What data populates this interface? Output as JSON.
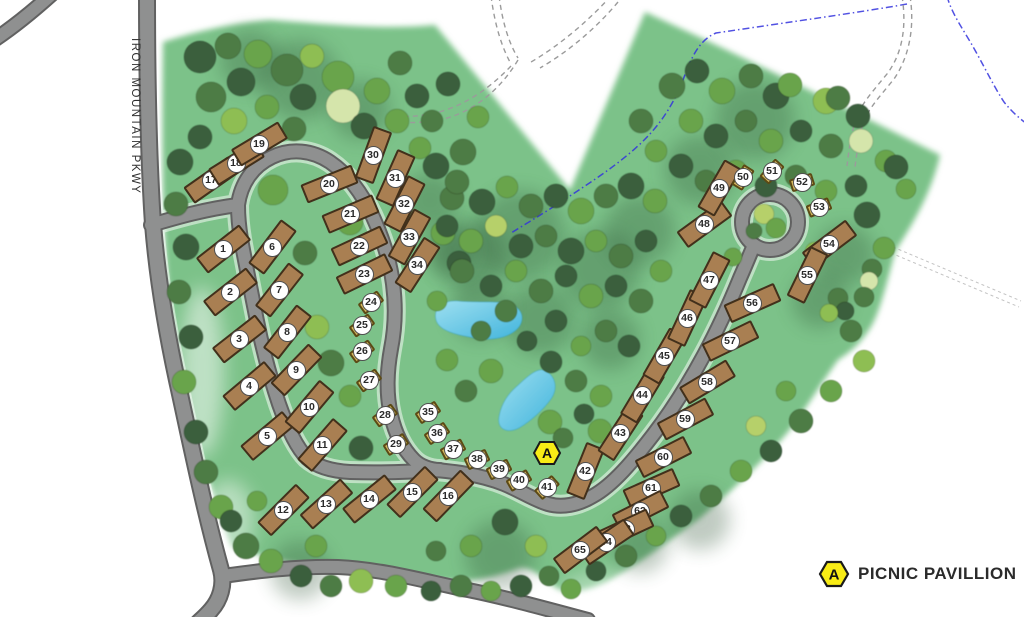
{
  "map": {
    "parkway_label": "IRON MOUNTAIN PKWY",
    "pavilion_marker": {
      "label": "A",
      "x": 547,
      "y": 453
    },
    "legend": {
      "marker_label": "A",
      "label": "PICNIC PAVILLION"
    }
  },
  "site_types": {
    "rv": {
      "w": 55,
      "h": 20
    },
    "tent": {
      "w": 24,
      "h": 13
    }
  },
  "sites_format": [
    "number",
    "x",
    "y",
    "angle_deg",
    "type"
  ],
  "sites": [
    [
      1,
      223,
      249,
      -38,
      "rv"
    ],
    [
      2,
      230,
      292,
      -38,
      "rv"
    ],
    [
      3,
      239,
      339,
      -38,
      "rv"
    ],
    [
      4,
      249,
      386,
      -40,
      "rv"
    ],
    [
      5,
      267,
      436,
      -40,
      "rv"
    ],
    [
      6,
      272,
      247,
      -53,
      "rv"
    ],
    [
      7,
      279,
      290,
      -52,
      "rv"
    ],
    [
      8,
      287,
      332,
      -52,
      "rv"
    ],
    [
      9,
      296,
      370,
      -46,
      "rv"
    ],
    [
      10,
      309,
      407,
      -50,
      "rv"
    ],
    [
      11,
      322,
      445,
      -49,
      "rv"
    ],
    [
      12,
      283,
      510,
      -45,
      "rv"
    ],
    [
      13,
      326,
      504,
      -42,
      "rv"
    ],
    [
      14,
      369,
      499,
      -39,
      "rv"
    ],
    [
      15,
      412,
      492,
      -45,
      "rv"
    ],
    [
      16,
      448,
      496,
      -46,
      "rv"
    ],
    [
      17,
      211,
      180,
      -35,
      "rv"
    ],
    [
      18,
      236,
      163,
      -32,
      "rv"
    ],
    [
      19,
      259,
      144,
      -31,
      "rv"
    ],
    [
      20,
      329,
      184,
      -22,
      "rv"
    ],
    [
      21,
      350,
      214,
      -23,
      "rv"
    ],
    [
      22,
      359,
      246,
      -25,
      "rv"
    ],
    [
      23,
      364,
      274,
      -26,
      "rv"
    ],
    [
      24,
      371,
      302,
      -36,
      "tent"
    ],
    [
      25,
      362,
      325,
      -36,
      "tent"
    ],
    [
      26,
      362,
      351,
      -36,
      "tent"
    ],
    [
      27,
      369,
      380,
      -36,
      "tent"
    ],
    [
      28,
      385,
      415,
      -36,
      "tent"
    ],
    [
      29,
      396,
      444,
      -32,
      "tent"
    ],
    [
      30,
      373,
      155,
      -70,
      "rv"
    ],
    [
      31,
      395,
      178,
      -66,
      "rv"
    ],
    [
      32,
      404,
      204,
      -63,
      "rv"
    ],
    [
      33,
      409,
      237,
      -61,
      "rv"
    ],
    [
      34,
      417,
      265,
      -57,
      "rv"
    ],
    [
      35,
      428,
      412,
      -33,
      "tent"
    ],
    [
      36,
      437,
      433,
      -33,
      "tent"
    ],
    [
      37,
      453,
      449,
      -28,
      "tent"
    ],
    [
      38,
      477,
      459,
      -25,
      "tent"
    ],
    [
      39,
      499,
      469,
      -26,
      "tent"
    ],
    [
      40,
      519,
      480,
      -30,
      "tent"
    ],
    [
      41,
      547,
      487,
      -42,
      "tent"
    ],
    [
      42,
      585,
      471,
      -68,
      "rv"
    ],
    [
      43,
      620,
      433,
      -57,
      "rv"
    ],
    [
      44,
      642,
      395,
      -59,
      "rv"
    ],
    [
      45,
      664,
      356,
      -60,
      "rv"
    ],
    [
      46,
      687,
      318,
      -65,
      "rv"
    ],
    [
      47,
      709,
      280,
      -63,
      "rv"
    ],
    [
      48,
      704,
      224,
      -36,
      "rv"
    ],
    [
      49,
      719,
      188,
      -60,
      "rv"
    ],
    [
      50,
      743,
      177,
      -58,
      "tent"
    ],
    [
      51,
      772,
      171,
      -48,
      "tent"
    ],
    [
      52,
      802,
      182,
      -18,
      "tent"
    ],
    [
      53,
      819,
      207,
      -22,
      "tent"
    ],
    [
      54,
      829,
      244,
      -37,
      "rv"
    ],
    [
      55,
      807,
      275,
      -64,
      "rv"
    ],
    [
      56,
      752,
      303,
      -24,
      "rv"
    ],
    [
      57,
      730,
      341,
      -26,
      "rv"
    ],
    [
      58,
      707,
      382,
      -31,
      "rv"
    ],
    [
      59,
      685,
      419,
      -28,
      "rv"
    ],
    [
      60,
      663,
      457,
      -27,
      "rv"
    ],
    [
      61,
      651,
      488,
      -24,
      "rv"
    ],
    [
      62,
      640,
      511,
      -27,
      "rv"
    ],
    [
      63,
      625,
      529,
      -25,
      "rv"
    ],
    [
      64,
      606,
      542,
      -34,
      "rv"
    ],
    [
      65,
      580,
      550,
      -37,
      "rv"
    ]
  ],
  "trees": {
    "palette": [
      "#3a5e3c",
      "#4e7c44",
      "#69a44b",
      "#8ebe53",
      "#b6d06b",
      "#d5e5ab"
    ],
    "items": [
      [
        200,
        57,
        16,
        0
      ],
      [
        228,
        46,
        13,
        1
      ],
      [
        258,
        54,
        14,
        2
      ],
      [
        287,
        70,
        16,
        1
      ],
      [
        241,
        82,
        14,
        0
      ],
      [
        211,
        97,
        15,
        1
      ],
      [
        312,
        56,
        12,
        3
      ],
      [
        338,
        77,
        16,
        2
      ],
      [
        303,
        97,
        13,
        0
      ],
      [
        267,
        107,
        12,
        2
      ],
      [
        343,
        106,
        17,
        5
      ],
      [
        377,
        91,
        13,
        2
      ],
      [
        400,
        63,
        12,
        1
      ],
      [
        417,
        96,
        12,
        0
      ],
      [
        234,
        121,
        13,
        3
      ],
      [
        200,
        137,
        12,
        0
      ],
      [
        294,
        129,
        12,
        1
      ],
      [
        364,
        126,
        13,
        0
      ],
      [
        397,
        121,
        12,
        2
      ],
      [
        432,
        121,
        11,
        1
      ],
      [
        448,
        84,
        12,
        0
      ],
      [
        463,
        152,
        13,
        1
      ],
      [
        478,
        117,
        11,
        2
      ],
      [
        420,
        148,
        11,
        2
      ],
      [
        180,
        162,
        13,
        0
      ],
      [
        176,
        204,
        12,
        1
      ],
      [
        186,
        247,
        13,
        0
      ],
      [
        179,
        292,
        12,
        1
      ],
      [
        191,
        337,
        12,
        0
      ],
      [
        184,
        382,
        12,
        2
      ],
      [
        196,
        432,
        12,
        0
      ],
      [
        206,
        472,
        12,
        1
      ],
      [
        221,
        507,
        12,
        2
      ],
      [
        273,
        190,
        15,
        2
      ],
      [
        350,
        222,
        13,
        2
      ],
      [
        305,
        253,
        12,
        1
      ],
      [
        317,
        327,
        12,
        3
      ],
      [
        331,
        363,
        13,
        1
      ],
      [
        350,
        396,
        11,
        2
      ],
      [
        361,
        448,
        12,
        0
      ],
      [
        436,
        166,
        13,
        0
      ],
      [
        452,
        198,
        12,
        1
      ],
      [
        443,
        233,
        12,
        2
      ],
      [
        459,
        263,
        12,
        0
      ],
      [
        457,
        182,
        12,
        1
      ],
      [
        482,
        202,
        13,
        0
      ],
      [
        507,
        187,
        11,
        2
      ],
      [
        531,
        206,
        12,
        1
      ],
      [
        556,
        196,
        12,
        0
      ],
      [
        581,
        211,
        13,
        2
      ],
      [
        606,
        196,
        12,
        1
      ],
      [
        631,
        186,
        13,
        0
      ],
      [
        655,
        201,
        12,
        2
      ],
      [
        447,
        226,
        11,
        0
      ],
      [
        471,
        241,
        12,
        2
      ],
      [
        496,
        226,
        11,
        4
      ],
      [
        521,
        246,
        12,
        0
      ],
      [
        546,
        236,
        11,
        1
      ],
      [
        571,
        251,
        13,
        0
      ],
      [
        596,
        241,
        11,
        2
      ],
      [
        621,
        256,
        12,
        1
      ],
      [
        646,
        241,
        11,
        0
      ],
      [
        462,
        271,
        12,
        1
      ],
      [
        491,
        286,
        11,
        0
      ],
      [
        516,
        271,
        11,
        2
      ],
      [
        541,
        291,
        12,
        1
      ],
      [
        566,
        276,
        11,
        0
      ],
      [
        591,
        296,
        12,
        2
      ],
      [
        616,
        286,
        11,
        0
      ],
      [
        641,
        301,
        12,
        1
      ],
      [
        661,
        271,
        11,
        2
      ],
      [
        437,
        301,
        10,
        2
      ],
      [
        506,
        311,
        11,
        1
      ],
      [
        556,
        321,
        11,
        0
      ],
      [
        606,
        331,
        11,
        1
      ],
      [
        629,
        346,
        11,
        0
      ],
      [
        581,
        346,
        10,
        2
      ],
      [
        527,
        341,
        10,
        0
      ],
      [
        481,
        331,
        10,
        1
      ],
      [
        447,
        360,
        11,
        2
      ],
      [
        491,
        371,
        12,
        2
      ],
      [
        466,
        391,
        11,
        1
      ],
      [
        551,
        362,
        11,
        0
      ],
      [
        576,
        381,
        11,
        1
      ],
      [
        601,
        396,
        11,
        2
      ],
      [
        550,
        422,
        12,
        2
      ],
      [
        563,
        438,
        10,
        1
      ],
      [
        584,
        414,
        10,
        0
      ],
      [
        600,
        431,
        12,
        2
      ],
      [
        672,
        86,
        13,
        1
      ],
      [
        697,
        71,
        12,
        0
      ],
      [
        722,
        91,
        13,
        2
      ],
      [
        751,
        76,
        12,
        1
      ],
      [
        776,
        96,
        13,
        0
      ],
      [
        790,
        85,
        12,
        2
      ],
      [
        826,
        101,
        13,
        3
      ],
      [
        838,
        98,
        12,
        1
      ],
      [
        858,
        116,
        12,
        0
      ],
      [
        691,
        121,
        12,
        2
      ],
      [
        716,
        136,
        12,
        0
      ],
      [
        746,
        121,
        11,
        1
      ],
      [
        771,
        141,
        12,
        2
      ],
      [
        801,
        131,
        11,
        0
      ],
      [
        831,
        146,
        12,
        1
      ],
      [
        861,
        141,
        12,
        5
      ],
      [
        886,
        161,
        11,
        2
      ],
      [
        681,
        166,
        12,
        0
      ],
      [
        706,
        181,
        11,
        1
      ],
      [
        736,
        171,
        11,
        2
      ],
      [
        766,
        186,
        11,
        0
      ],
      [
        796,
        176,
        11,
        1
      ],
      [
        826,
        191,
        11,
        2
      ],
      [
        856,
        186,
        11,
        0
      ],
      [
        641,
        121,
        12,
        1
      ],
      [
        656,
        151,
        11,
        2
      ],
      [
        906,
        189,
        10,
        2
      ],
      [
        896,
        167,
        12,
        0
      ],
      [
        764,
        214,
        10,
        4
      ],
      [
        776,
        228,
        10,
        2
      ],
      [
        754,
        231,
        8,
        1
      ],
      [
        815,
        252,
        10,
        3
      ],
      [
        733,
        257,
        9,
        2
      ],
      [
        867,
        215,
        13,
        0
      ],
      [
        884,
        248,
        11,
        2
      ],
      [
        872,
        269,
        10,
        1
      ],
      [
        869,
        281,
        9,
        5
      ],
      [
        864,
        297,
        10,
        1
      ],
      [
        838,
        298,
        10,
        1
      ],
      [
        845,
        311,
        9,
        0
      ],
      [
        829,
        313,
        9,
        3
      ],
      [
        851,
        331,
        11,
        1
      ],
      [
        864,
        361,
        11,
        3
      ],
      [
        831,
        391,
        11,
        2
      ],
      [
        801,
        421,
        12,
        1
      ],
      [
        771,
        451,
        11,
        0
      ],
      [
        741,
        471,
        11,
        2
      ],
      [
        711,
        496,
        11,
        1
      ],
      [
        681,
        516,
        11,
        0
      ],
      [
        656,
        536,
        10,
        2
      ],
      [
        626,
        556,
        11,
        1
      ],
      [
        596,
        571,
        10,
        0
      ],
      [
        786,
        391,
        10,
        2
      ],
      [
        756,
        426,
        10,
        4
      ],
      [
        246,
        546,
        13,
        1
      ],
      [
        271,
        561,
        12,
        2
      ],
      [
        301,
        576,
        11,
        0
      ],
      [
        331,
        586,
        11,
        1
      ],
      [
        361,
        581,
        12,
        3
      ],
      [
        396,
        586,
        11,
        2
      ],
      [
        431,
        591,
        10,
        0
      ],
      [
        461,
        586,
        11,
        1
      ],
      [
        491,
        591,
        10,
        2
      ],
      [
        521,
        586,
        11,
        0
      ],
      [
        549,
        576,
        10,
        1
      ],
      [
        505,
        522,
        13,
        0
      ],
      [
        471,
        546,
        11,
        2
      ],
      [
        436,
        551,
        10,
        1
      ],
      [
        536,
        546,
        11,
        3
      ],
      [
        231,
        521,
        11,
        0
      ],
      [
        257,
        501,
        10,
        2
      ],
      [
        316,
        546,
        11,
        2
      ],
      [
        571,
        589,
        10,
        2
      ]
    ],
    "canopy_shadows": [
      [
        520,
        235,
        45
      ],
      [
        470,
        255,
        35
      ],
      [
        600,
        270,
        40
      ],
      [
        640,
        230,
        35
      ],
      [
        755,
        120,
        40
      ],
      [
        700,
        170,
        35
      ],
      [
        845,
        255,
        30
      ],
      [
        300,
        80,
        40
      ],
      [
        360,
        110,
        30
      ],
      [
        540,
        320,
        35
      ],
      [
        480,
        310,
        30
      ],
      [
        610,
        340,
        30
      ],
      [
        820,
        300,
        28
      ],
      [
        700,
        520,
        30
      ],
      [
        640,
        545,
        28
      ],
      [
        500,
        555,
        35
      ],
      [
        300,
        570,
        30
      ],
      [
        250,
        60,
        30
      ],
      [
        430,
        200,
        28
      ],
      [
        450,
        250,
        25
      ]
    ]
  }
}
